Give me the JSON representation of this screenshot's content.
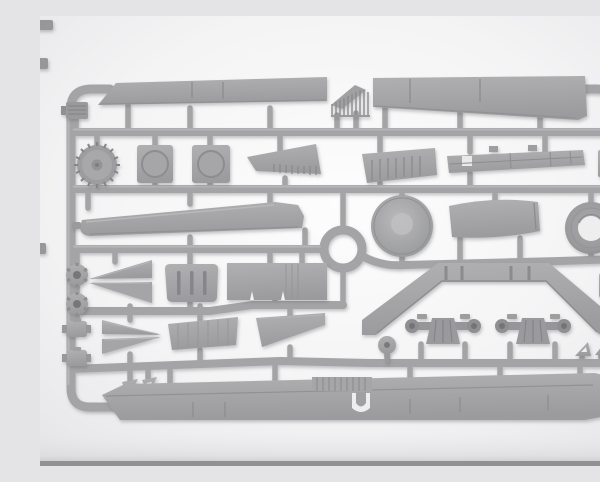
{
  "scene": {
    "type": "product-photo",
    "description": "Light grey injection-moulded plastic model kit sprue photographed on a white studio backdrop with soft shadows and a grey base edge at the bottom",
    "subject": "model-kit-sprue",
    "text_visible": "none"
  },
  "palette": {
    "plastic_mid": "#a2a2a4",
    "plastic_light": "#b2b2b4",
    "plastic_dark": "#8a8a8c",
    "detail_dark": "#636366",
    "background_center": "#fdfdfd",
    "background_edge": "#e6e6e8",
    "floor_strip": "#919193",
    "shadow": "#5f5f63"
  },
  "sprue": {
    "frame_shape": "rounded rectangle runner frame with five horizontal runners, a central ring runner and many short feed gates",
    "parts_count": 38,
    "parts": [
      {
        "id": "upper-span-panel-left",
        "label": "long tapered span panel, top left"
      },
      {
        "id": "upper-span-panel-right",
        "label": "long tapered span panel, top right"
      },
      {
        "id": "ladder-part",
        "label": "small angled ladder/grille piece between top panels"
      },
      {
        "id": "ribbed-block",
        "label": "small ribbed block, top left corner"
      },
      {
        "id": "small-hub",
        "label": "small wheel hub with dark bore, top right"
      },
      {
        "id": "toothed-wheel",
        "label": "toothed disc wheel"
      },
      {
        "id": "hatch-plate-1",
        "label": "square hatch plate with circular boss"
      },
      {
        "id": "hatch-plate-2",
        "label": "square hatch plate with circular boss"
      },
      {
        "id": "ribbed-wedge-left",
        "label": "ribbed wedge panel, row two left"
      },
      {
        "id": "ribbed-wedge-right",
        "label": "ribbed wedge panel, row two right"
      },
      {
        "id": "chassis-beam",
        "label": "long flat chassis beam with opening"
      },
      {
        "id": "hub-plate",
        "label": "square plate with dark round boss, right edge"
      },
      {
        "id": "tapered-plank",
        "label": "long tapered plank, middle left"
      },
      {
        "id": "ring-runner",
        "label": "central circular runner ring"
      },
      {
        "id": "wheel-disc",
        "label": "solid road-wheel disc"
      },
      {
        "id": "curved-panel",
        "label": "gently curved roof panel"
      },
      {
        "id": "tyre",
        "label": "tyre ring with open centre"
      },
      {
        "id": "lug-ring-1",
        "label": "small lugged hub ring, left column"
      },
      {
        "id": "lug-ring-2",
        "label": "small lugged hub ring, left column"
      },
      {
        "id": "bow-halves-upper",
        "label": "pair of pointed bow halves, points left"
      },
      {
        "id": "slotted-hatch",
        "label": "rounded hatch with three slots"
      },
      {
        "id": "floor-panel",
        "label": "large rectangular floor panel"
      },
      {
        "id": "v-fender",
        "label": "wide shallow V fender strip"
      },
      {
        "id": "axle-1",
        "label": "axle assembly with differential"
      },
      {
        "id": "axle-2",
        "label": "axle assembly with differential"
      },
      {
        "id": "pulley-wheel",
        "label": "small pulley wheel on stem"
      },
      {
        "id": "drum-1",
        "label": "small drum with side tabs"
      },
      {
        "id": "drum-2",
        "label": "small drum with side tabs"
      },
      {
        "id": "bow-halves-lower",
        "label": "pair of pointed bow halves, points right"
      },
      {
        "id": "rib-panel-1",
        "label": "ribbed trapezoid panel"
      },
      {
        "id": "rib-panel-2",
        "label": "tapering blade panel"
      },
      {
        "id": "bracket-left-1",
        "label": "small triangular bracket"
      },
      {
        "id": "bracket-left-2",
        "label": "small triangular bracket"
      },
      {
        "id": "bracket-right-1",
        "label": "small triangular bracket"
      },
      {
        "id": "bracket-right-2",
        "label": "small triangular bracket"
      },
      {
        "id": "slotted-box",
        "label": "small slotted box, right edge"
      },
      {
        "id": "small-box",
        "label": "small detail box, lower right"
      },
      {
        "id": "lower-span-panel",
        "label": "long span panel with ribbed centre, bottom"
      }
    ]
  }
}
